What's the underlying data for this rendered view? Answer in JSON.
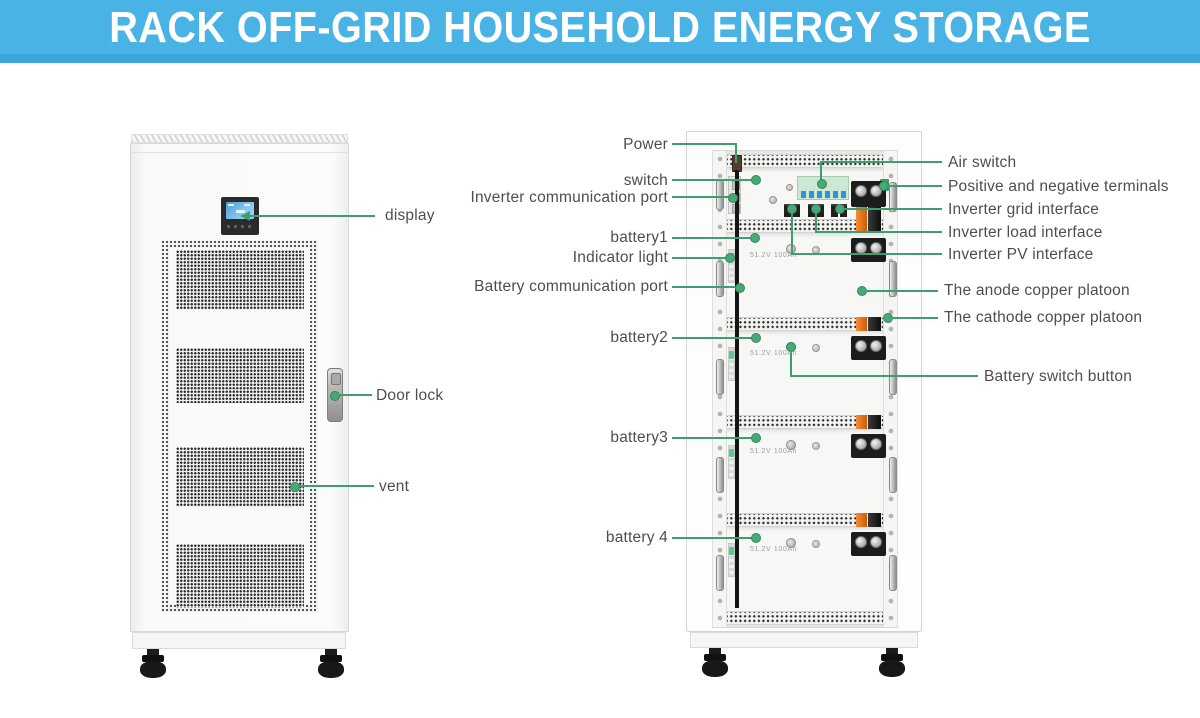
{
  "banner": {
    "title": "RACK OFF-GRID HOUSEHOLD ENERGY STORAGE"
  },
  "front_unit": {
    "labels": {
      "display": "display",
      "door_lock": "Door lock",
      "vent": "vent"
    }
  },
  "rack_unit": {
    "battery_plate": "51.2V 100Ah",
    "left_labels": {
      "power": "Power",
      "switch": "switch",
      "inverter_comm_port": "Inverter communication port",
      "battery1": "battery1",
      "indicator_light": "Indicator light",
      "battery_comm_port": "Battery communication port",
      "battery2": "battery2",
      "battery3": "battery3",
      "battery4": "battery 4"
    },
    "right_labels": {
      "air_switch": "Air switch",
      "terminals": "Positive and negative terminals",
      "grid_interface": "Inverter grid interface",
      "load_interface": "Inverter load interface",
      "pv_interface": "Inverter PV interface",
      "anode": "The anode copper platoon",
      "cathode": "The cathode copper platoon",
      "battery_switch": "Battery switch button"
    }
  },
  "colors": {
    "banner_blue": "#4ab3e6",
    "banner_strip": "#3aa6da",
    "leader_green": "#3f9e6e",
    "callout_dot_green": "#4aa877",
    "busbar_orange": "#e8761c",
    "busbar_black": "#232323",
    "label_text": "#4e4e4e"
  }
}
